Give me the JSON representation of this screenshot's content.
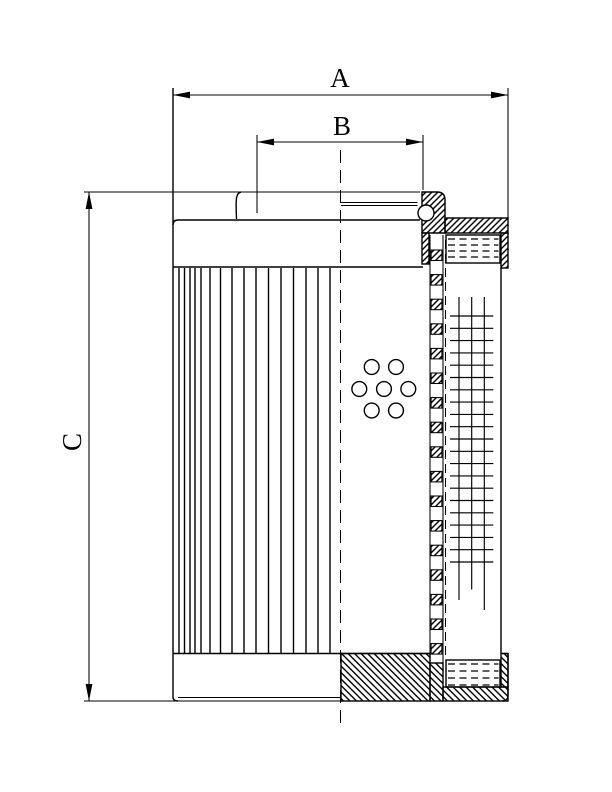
{
  "colors": {
    "line": "#000000",
    "background": "#ffffff"
  },
  "dimensions": {
    "a": {
      "label": "A"
    },
    "b": {
      "label": "B"
    },
    "c": {
      "label": "C"
    }
  },
  "geometry": {
    "pleats": {
      "x": [
        179,
        184.5,
        190,
        195,
        201,
        210,
        220.5,
        232,
        244,
        256,
        268.5,
        281,
        293.5,
        306,
        318,
        330
      ],
      "y1": 268,
      "y2": 653.5
    },
    "holes": {
      "r": 7.4,
      "centers": [
        [
          371.7,
          367
        ],
        [
          396,
          367
        ],
        [
          359.3,
          389
        ],
        [
          384,
          389
        ],
        [
          408.3,
          389
        ],
        [
          371.7,
          410.5
        ],
        [
          396,
          410.5
        ]
      ]
    },
    "core_squares": {
      "x": 431.1,
      "width": 10.8,
      "y_start": 250,
      "period": 24.6,
      "height": 10.5,
      "y_end": 663
    },
    "mesh": {
      "horizontal": {
        "x1": 450,
        "x2": 493.3,
        "y_start": 316,
        "dy": 12.3,
        "count": 21
      },
      "vertical": [
        {
          "x": 459,
          "y1": 297,
          "y2": 600
        },
        {
          "x": 471.7,
          "y1": 297,
          "y2": 589.5
        },
        {
          "x": 484.3,
          "y1": 297,
          "y2": 610
        }
      ]
    },
    "threads_top": {
      "x1": 448,
      "x2": 498.5,
      "rows": [
        239,
        245,
        251,
        257
      ]
    },
    "threads_bottom": {
      "x1": 448,
      "x2": 498.5,
      "rows": [
        664,
        671,
        678,
        685
      ]
    }
  }
}
